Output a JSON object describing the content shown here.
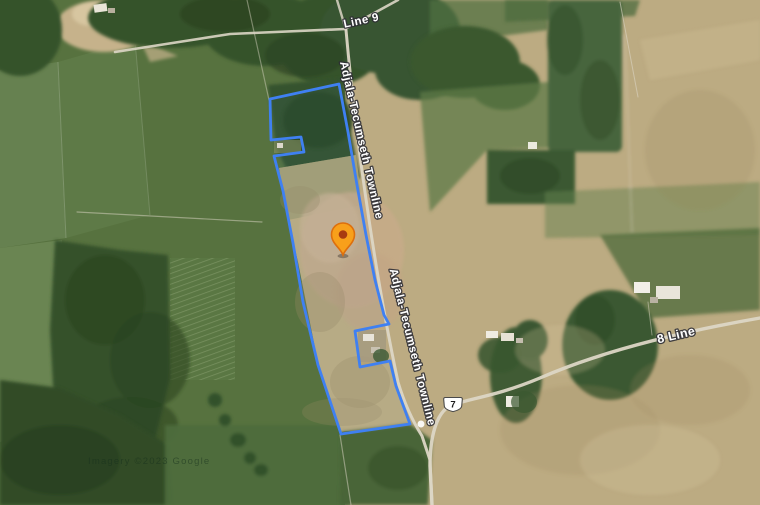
{
  "map": {
    "view": "Satellite",
    "labels": {
      "line9": "Line 9",
      "townline": "Adjala-Tecumseth Townline",
      "line8": "8 Line"
    },
    "route_shield": "7",
    "watermark": "Imagery ©2023 Google",
    "marker": {
      "name": "property-location-pin"
    },
    "colors": {
      "boundary": "#3f80f2",
      "pin_body": "#f8a01b",
      "pin_border": "#dd6f0d",
      "pin_dot": "#a83a10",
      "road": "#dcd6c5",
      "label_text": "#ffffff"
    }
  }
}
